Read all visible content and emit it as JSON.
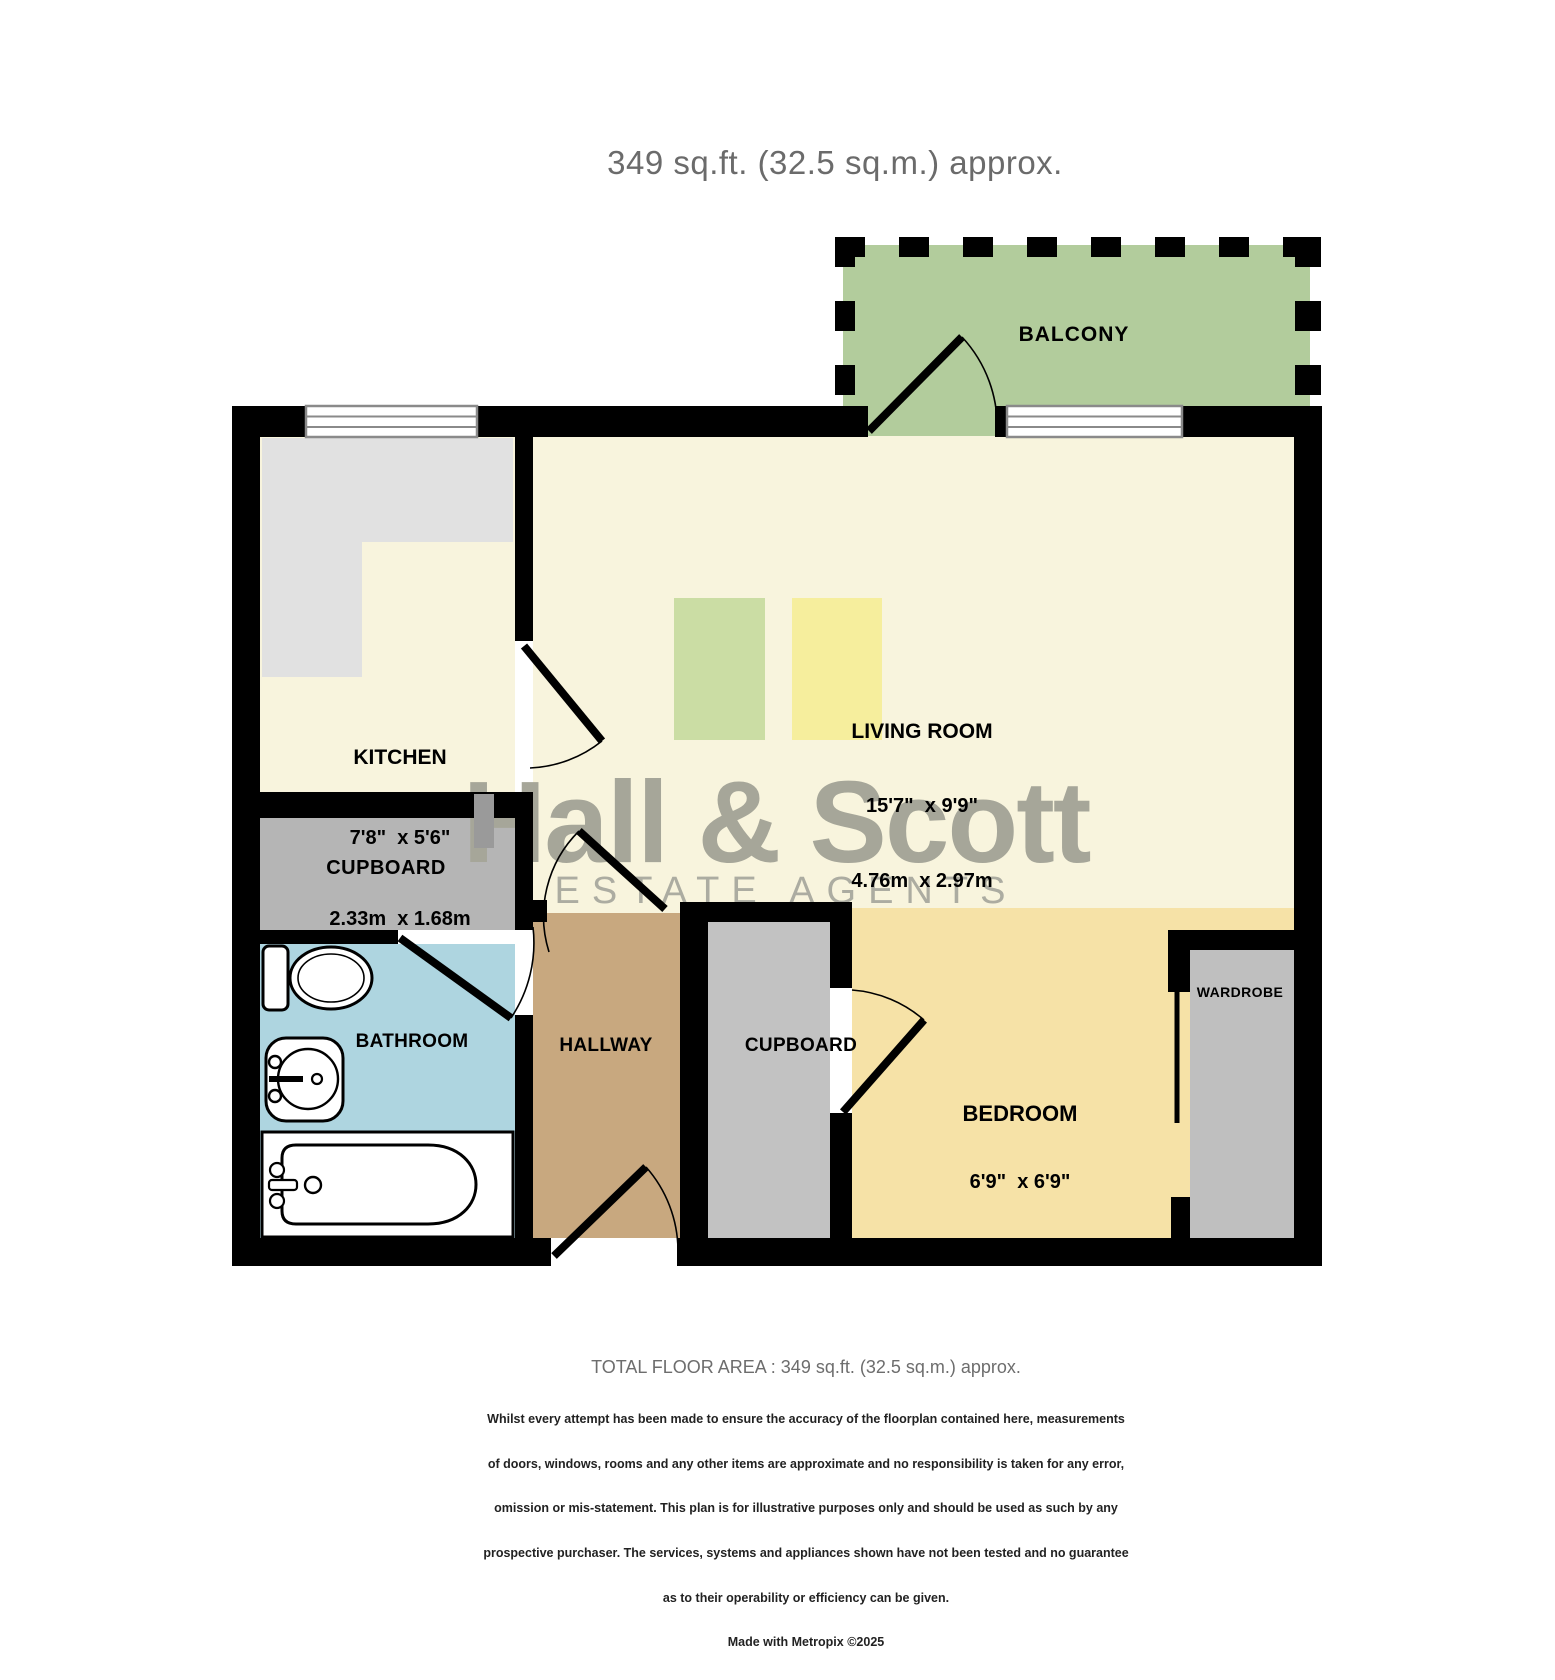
{
  "title": "349 sq.ft. (32.5 sq.m.) approx.",
  "watermark": {
    "name": "Hall & Scott",
    "tagline": "ESTATE AGENTS"
  },
  "rooms": {
    "balcony": {
      "label": "BALCONY"
    },
    "kitchen": {
      "label": "KITCHEN",
      "size_imperial": "7'8\"  x 5'6\"",
      "size_metric": "2.33m  x 1.68m"
    },
    "living_room": {
      "label": "LIVING ROOM",
      "size_imperial": "15'7\"  x 9'9\"",
      "size_metric": "4.76m  x 2.97m"
    },
    "cupboard_upper": {
      "label": "CUPBOARD"
    },
    "bathroom": {
      "label": "BATHROOM"
    },
    "hallway": {
      "label": "HALLWAY"
    },
    "cupboard_lower": {
      "label": "CUPBOARD"
    },
    "bedroom": {
      "label": "BEDROOM",
      "size_imperial": "6'9\"  x 6'9\"",
      "size_metric": "2.07m  x 2.07m"
    },
    "wardrobe": {
      "label": "WARDROBE"
    }
  },
  "footer": {
    "total": "TOTAL FLOOR AREA : 349 sq.ft. (32.5 sq.m.) approx.",
    "disclaimer_lines": [
      "Whilst every attempt has been made to ensure the accuracy of the floorplan contained here, measurements",
      "of doors, windows, rooms and any other items are approximate and no responsibility is taken for any error,",
      "omission or mis-statement. This plan is for illustrative purposes only and should be used as such by any",
      "prospective purchaser. The services, systems and appliances shown have not been tested and no guarantee",
      "as to their operability or efficiency can be given.",
      "Made with Metropix ©2025"
    ]
  },
  "colors": {
    "wall": "#000000",
    "floor_cream": "#f8f4dd",
    "bedroom_yellow": "#f6e2a7",
    "balcony_green": "#b2cc9c",
    "bathroom_blue": "#aed5e0",
    "hallway_tan": "#c8a87f",
    "cupboard_gray": "#b5b5b5",
    "cupboard2_gray": "#c2c2c2",
    "wardrobe_gray": "#bfbfbf",
    "counter_gray": "#e1e1e1",
    "rug_green": "#cbdda4",
    "rug_yellow": "#f6ee9d",
    "watermark_gray": "#a6a699",
    "title_gray": "#6b6b6b"
  }
}
